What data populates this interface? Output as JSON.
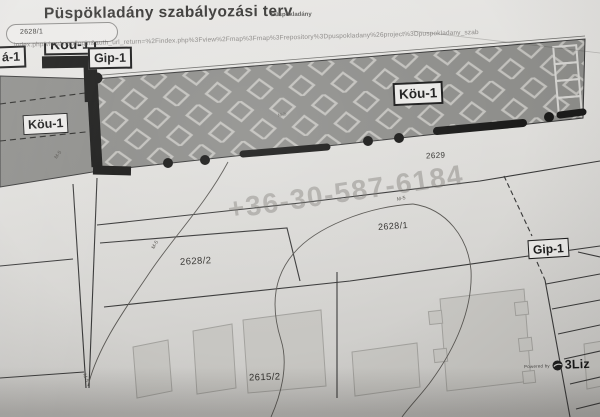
{
  "title": {
    "main": "Püspökladány szabályozási terv",
    "suffix": "Püspökladány"
  },
  "tooltip": {
    "value": "2628/1"
  },
  "watermarks": {
    "url": "index.php/view/map/login&auth_url_return=%2Findex.php%3Fview%2Fmap%3Fmap%3Frepository%3Dpuspokladany%26project%3Dpuspokladany_szab",
    "phone": "+36-30-587-6184",
    "powered_by": "Powered by",
    "brand": "3Liz"
  },
  "zone_labels": {
    "kou1_top": "Köu-1",
    "ma1": "á-1",
    "gip1_top": "Gip-1",
    "kou1_left": "Köu-1",
    "kou1_band": "Köu-1",
    "gip1_right": "Gip-1"
  },
  "parcels": {
    "p2629": "2629",
    "p2628_1": "2628/1",
    "p2628_2": "2628/2",
    "p2615_2": "2615/2"
  },
  "tiny_marker": {
    "text": "M-5"
  },
  "colors": {
    "paper": "#dddcd9",
    "road_band": "#8e8e8b",
    "diamond_outline": "#c2c1bd",
    "boundary_line": "#3a3a3a",
    "thick_boundary": "#1b1b1b",
    "building_fill": "#c7c6c2"
  }
}
